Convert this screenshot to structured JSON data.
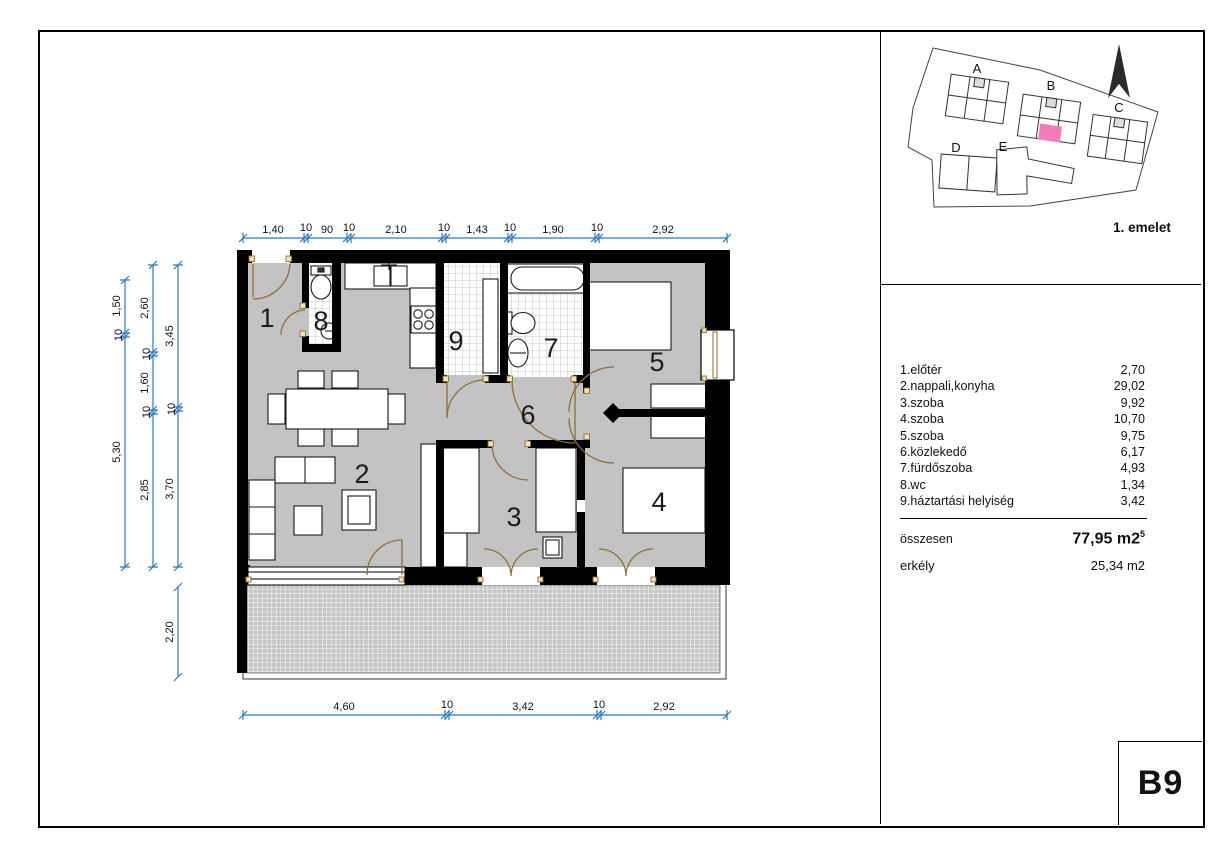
{
  "panel": {
    "unit_label": "B9",
    "floor_label": "1. emelet"
  },
  "site_plan": {
    "buildings": [
      "A",
      "B",
      "C",
      "D",
      "E"
    ],
    "highlight_color": "#f07cb8"
  },
  "legend": {
    "rows": [
      {
        "label": "1.előtér",
        "value": "2,70"
      },
      {
        "label": "2.nappali,konyha",
        "value": "29,02"
      },
      {
        "label": "3.szoba",
        "value": "9,92"
      },
      {
        "label": "4.szoba",
        "value": "10,70"
      },
      {
        "label": "5.szoba",
        "value": "9,75"
      },
      {
        "label": "6.közlekedő",
        "value": "6,17"
      },
      {
        "label": "7.fürdőszoba",
        "value": "4,93"
      },
      {
        "label": "8.wc",
        "value": "1,34"
      },
      {
        "label": "9.háztartási helyiség",
        "value": "3,42"
      }
    ],
    "total_label": "összesen",
    "total_value": "77,95 m2",
    "total_sup": "5",
    "balcony_label": "erkély",
    "balcony_value": "25,34 m2"
  },
  "plan": {
    "rooms": [
      "1",
      "2",
      "3",
      "4",
      "5",
      "6",
      "7",
      "8",
      "9"
    ],
    "colors": {
      "floor": "#c3c3c3",
      "wall": "#000000",
      "door": "#8f6f33",
      "dimension": "#2e78c2"
    }
  },
  "dims": {
    "top": [
      "1,40",
      "10",
      "90",
      "10",
      "2,10",
      "10",
      "1,43",
      "10",
      "1,90",
      "10",
      "2,92"
    ],
    "bottom": [
      "4,60",
      "10",
      "3,42",
      "10",
      "2,92"
    ],
    "left_outer": [
      "1,50",
      "10",
      "5,30"
    ],
    "left_mid": [
      "2,60",
      "10",
      "1,60",
      "10",
      "2,85"
    ],
    "left_inner": [
      "3,45",
      "10",
      "3,70"
    ],
    "balcony_depth": "2,20"
  }
}
